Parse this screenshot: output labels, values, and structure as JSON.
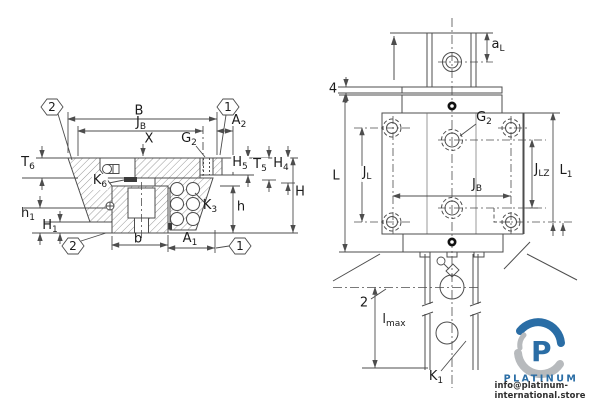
{
  "left_view": {
    "callout_top_left": "2",
    "callout_top_right": "1",
    "callout_bottom_left": "2",
    "callout_bottom_right": "1",
    "dims": {
      "B": "B",
      "JB": {
        "main": "J",
        "sub": "B"
      },
      "A2": {
        "main": "A",
        "sub": "2"
      },
      "X": "X",
      "G2": {
        "main": "G",
        "sub": "2"
      },
      "T6": {
        "main": "T",
        "sub": "6"
      },
      "K6": {
        "main": "K",
        "sub": "6"
      },
      "K3": {
        "main": "K",
        "sub": "3"
      },
      "H5": {
        "main": "H",
        "sub": "5"
      },
      "T5": {
        "main": "T",
        "sub": "5"
      },
      "H4": {
        "main": "H",
        "sub": "4"
      },
      "H": "H",
      "h": "h",
      "h1": {
        "main": "h",
        "sub": "1"
      },
      "H1": {
        "main": "H",
        "sub": "1"
      },
      "b": "b",
      "A1": {
        "main": "A",
        "sub": "1"
      }
    }
  },
  "right_view": {
    "callout_seal": "4",
    "callout_datum": "2",
    "dims": {
      "aL": {
        "main": "a",
        "sub": "L"
      },
      "L": "L",
      "JL": {
        "main": "J",
        "sub": "L"
      },
      "G2": {
        "main": "G",
        "sub": "2"
      },
      "JB": {
        "main": "J",
        "sub": "B"
      },
      "JLZ": {
        "main": "J",
        "sub": "LZ"
      },
      "L1": {
        "main": "L",
        "sub": "1"
      },
      "lmax": {
        "main": "l",
        "sub": "max"
      },
      "K1": {
        "main": "K",
        "sub": "1"
      }
    }
  },
  "watermark": {
    "monogram": "P",
    "brand": "PLATINUM",
    "contact": "info@platinum-international.store",
    "brand_color": "#2a6da5",
    "swirl_gray": "#b7babd"
  }
}
